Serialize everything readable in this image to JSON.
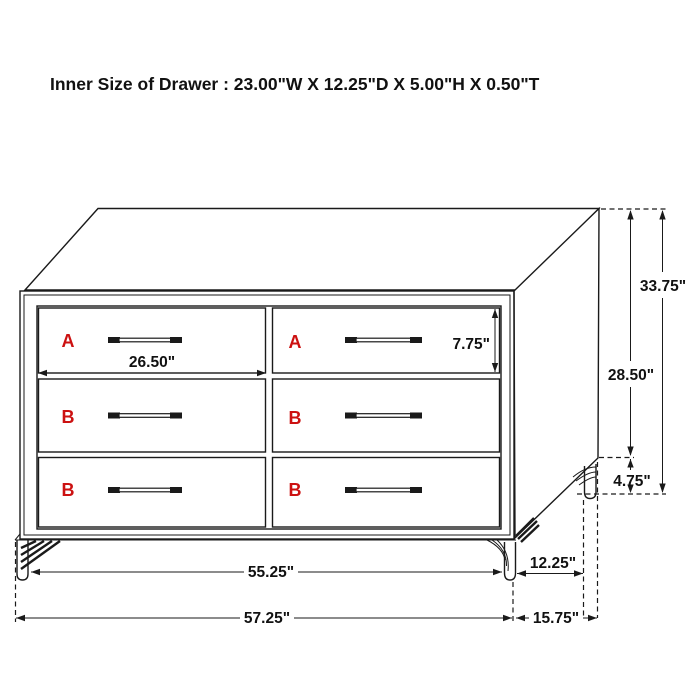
{
  "title": "Inner Size of Drawer : 23.00\"W X 12.25\"D X 5.00\"H X 0.50\"T",
  "diagram": {
    "type": "furniture-dimension-diagram",
    "item": "6-drawer dresser with hairpin legs",
    "drawers": [
      "A",
      "A",
      "B",
      "B",
      "B",
      "B"
    ],
    "dims": {
      "drawer_width": "26.50\"",
      "drawer_height": "7.75\"",
      "overall_height": "33.75\"",
      "body_height": "28.50\"",
      "leg_height": "4.75\"",
      "body_width": "55.25\"",
      "leg_inset_depth": "12.25\"",
      "overall_width": "57.25\"",
      "overall_depth": "15.75\""
    }
  },
  "colors": {
    "label": "#cc1111",
    "line": "#1a1a1a"
  }
}
